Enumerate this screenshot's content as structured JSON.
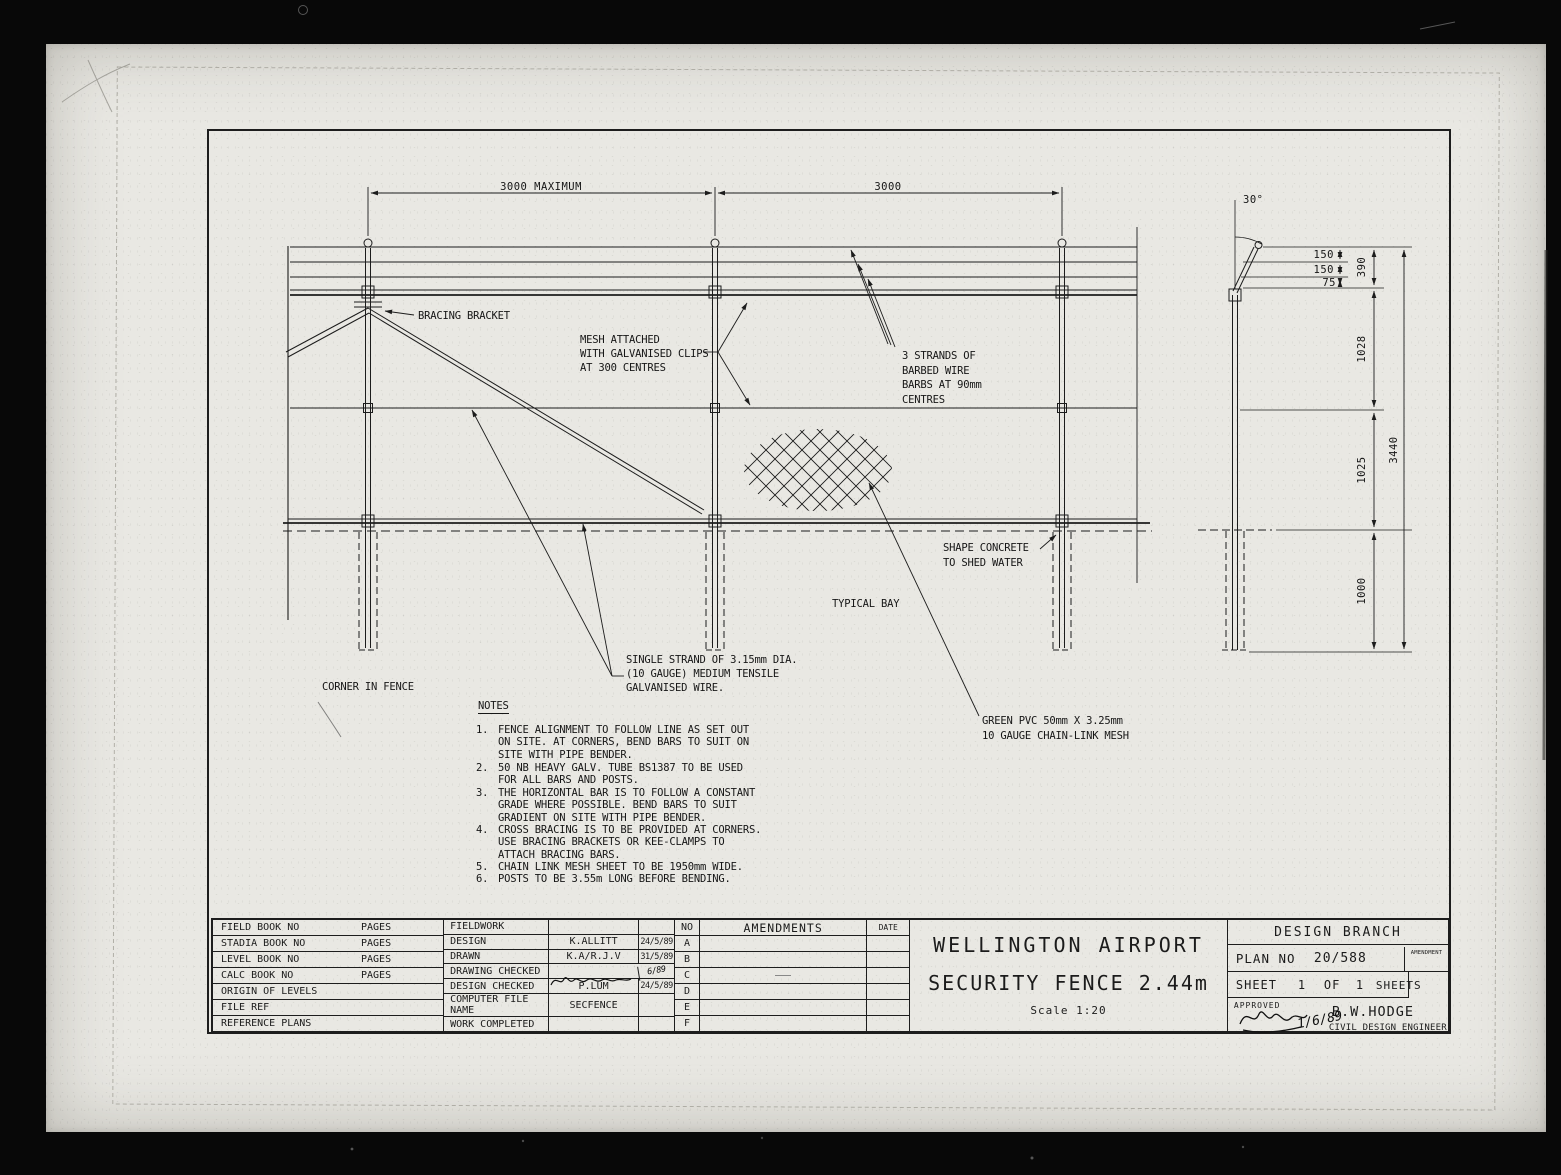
{
  "drawing": {
    "dims": {
      "bay1": "3000 MAXIMUM",
      "bay2": "3000",
      "angle": "30°",
      "s150a": "150",
      "s150b": "150",
      "s75": "75",
      "d390": "390",
      "d1028": "1028",
      "d1025": "1025",
      "d1000": "1000",
      "d3440": "3440"
    },
    "labels": {
      "bracing_bracket": "BRACING BRACKET",
      "mesh_attached": "MESH ATTACHED\nWITH GALVANISED CLIPS\nAT 300 CENTRES",
      "strands": "3 STRANDS OF\nBARBED WIRE\nBARBS AT 90mm\nCENTRES",
      "shape_concrete": "SHAPE CONCRETE\nTO SHED WATER",
      "typical_bay": "TYPICAL BAY",
      "corner_in_fence": "CORNER IN FENCE",
      "single_strand": "SINGLE STRAND OF 3.15mm DIA.\n(10 GAUGE) MEDIUM TENSILE\nGALVANISED WIRE.",
      "green_pvc": "GREEN PVC 50mm X 3.25mm\n10 GAUGE CHAIN-LINK MESH"
    },
    "notes": {
      "title": "NOTES",
      "items": [
        {
          "num": "1.",
          "text": "FENCE ALIGNMENT TO FOLLOW LINE AS SET OUT\nON SITE. AT CORNERS, BEND BARS TO SUIT ON\nSITE WITH PIPE BENDER."
        },
        {
          "num": "2.",
          "text": "50 NB HEAVY GALV. TUBE BS1387 TO BE USED\nFOR ALL BARS AND POSTS."
        },
        {
          "num": "3.",
          "text": "THE HORIZONTAL BAR IS TO FOLLOW A CONSTANT\nGRADE WHERE POSSIBLE. BEND BARS TO SUIT\nGRADIENT ON SITE WITH PIPE BENDER."
        },
        {
          "num": "4.",
          "text": "CROSS BRACING IS TO BE PROVIDED AT CORNERS.\nUSE BRACING BRACKETS OR KEE-CLAMPS TO\nATTACH BRACING BARS."
        },
        {
          "num": "5.",
          "text": "CHAIN LINK MESH SHEET TO BE 1950mm WIDE."
        },
        {
          "num": "6.",
          "text": "POSTS TO BE 3.55m LONG BEFORE BENDING."
        }
      ]
    }
  },
  "title_block": {
    "book_rows": [
      {
        "label": "FIELD BOOK NO",
        "pages": "PAGES"
      },
      {
        "label": "STADIA BOOK NO",
        "pages": "PAGES"
      },
      {
        "label": "LEVEL BOOK NO",
        "pages": "PAGES"
      },
      {
        "label": "CALC BOOK NO",
        "pages": "PAGES"
      },
      {
        "label": "ORIGIN OF LEVELS",
        "pages": ""
      },
      {
        "label": "FILE REF",
        "pages": ""
      },
      {
        "label": "REFERENCE PLANS",
        "pages": ""
      }
    ],
    "work_rows": [
      {
        "label": "FIELDWORK",
        "name": "",
        "date": ""
      },
      {
        "label": "DESIGN",
        "name": "K.ALLITT",
        "date": "24/5/89"
      },
      {
        "label": "DRAWN",
        "name": "K.A/R.J.V",
        "date": "31/5/89"
      },
      {
        "label": "DRAWING CHECKED",
        "name": "",
        "date": "6/89"
      },
      {
        "label": "DESIGN CHECKED",
        "name": "P.LUM",
        "date": "24/5/89"
      },
      {
        "label": "COMPUTER FILE NAME",
        "name": "SECFENCE",
        "date": ""
      },
      {
        "label": "WORK COMPLETED",
        "name": "",
        "date": ""
      }
    ],
    "amendments": {
      "no_header": "NO",
      "title": "AMENDMENTS",
      "date_header": "DATE",
      "rows": [
        "A",
        "B",
        "C",
        "D",
        "E",
        "F"
      ]
    },
    "title": {
      "line1": "WELLINGTON AIRPORT",
      "line2": "SECURITY FENCE 2.44m",
      "scale": "Scale 1:20"
    },
    "branch": {
      "name": "DESIGN BRANCH",
      "plan_no_label": "PLAN NO",
      "plan_no": "20/588",
      "amendment_label": "AMENDMENT",
      "sheet_label": "SHEET",
      "sheet_no": "1",
      "of_label": "OF",
      "sheet_count": "1",
      "sheets_label": "SHEETS",
      "approved_label": "APPROVED",
      "approved_name": "B.W.HODGE",
      "approved_date": "1/6/89",
      "approved_title": "CIVIL DESIGN ENGINEER"
    }
  }
}
